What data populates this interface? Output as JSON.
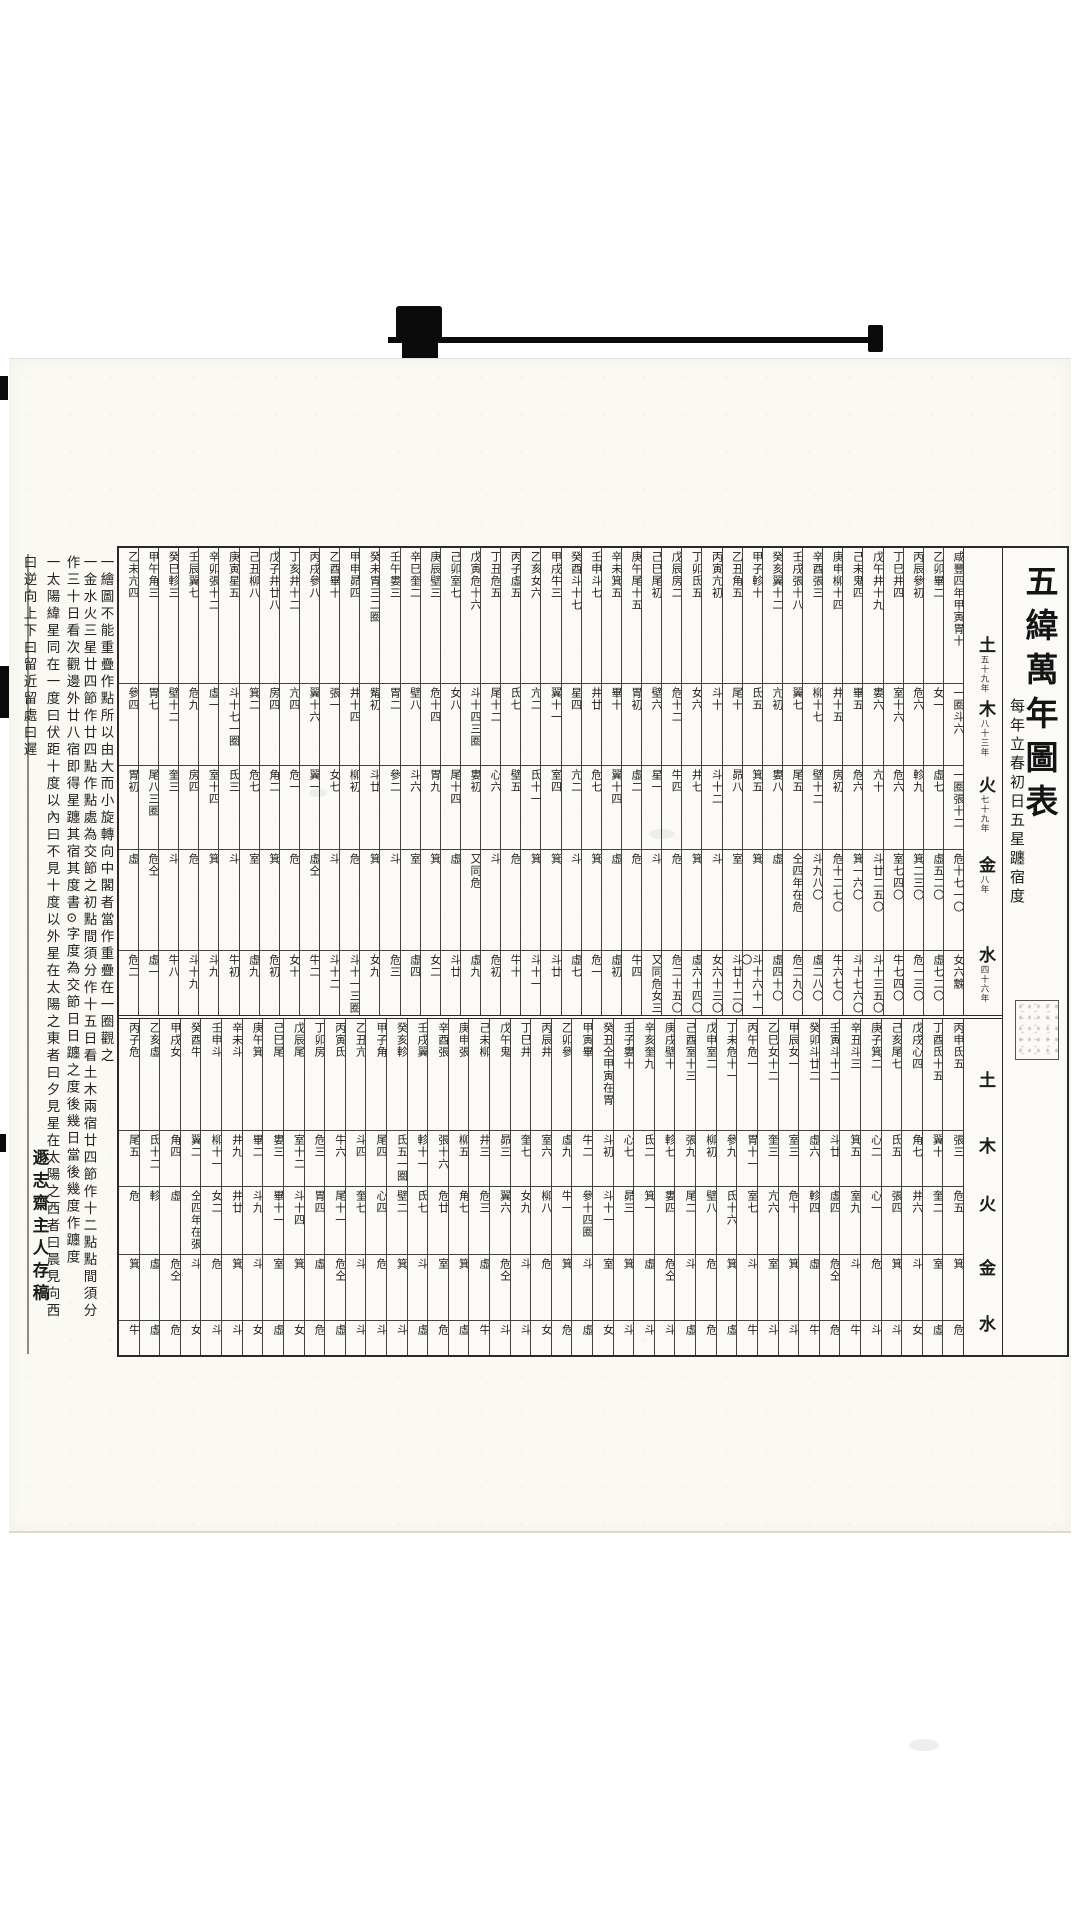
{
  "title": {
    "main": "五緯萬年圖表",
    "subtitle": "每年立春初日五星躔宿度"
  },
  "planet_labels": {
    "upper": [
      {
        "name": "土",
        "period": "五十九年"
      },
      {
        "name": "木",
        "period": "八十三年"
      },
      {
        "name": "火",
        "period": "七十九年"
      },
      {
        "name": "金",
        "period": "八年"
      },
      {
        "name": "水",
        "period": "四十六年"
      }
    ],
    "lower": [
      {
        "name": "土"
      },
      {
        "name": "木"
      },
      {
        "name": "火"
      },
      {
        "name": "金"
      },
      {
        "name": "水"
      }
    ]
  },
  "bands": {
    "upper": {
      "columns": [
        {
          "year": "咸豐四年甲寅",
          "saturn": "胃十",
          "wood": "一圈斗六",
          "fire": "一圈張十二",
          "venus": "危十七一〇",
          "mercury": "女六䨲"
        },
        {
          "year": "乙卯",
          "saturn": "畢二",
          "wood": "女一",
          "fire": "虛七",
          "venus": "虛五二〇",
          "mercury": "虛七二〇"
        },
        {
          "year": "丙辰",
          "saturn": "參初",
          "wood": "危六",
          "fire": "軫九",
          "venus": "箕二三〇",
          "mercury": "危一三〇"
        },
        {
          "year": "丁巳",
          "saturn": "井四",
          "wood": "室十六",
          "fire": "危六",
          "venus": "室七四〇",
          "mercury": "牛七四〇"
        },
        {
          "year": "戊午",
          "saturn": "井十九",
          "wood": "婁六",
          "fire": "亢十",
          "venus": "斗廿二五〇",
          "mercury": "斗十三五〇"
        },
        {
          "year": "己未",
          "saturn": "鬼四",
          "wood": "畢五",
          "fire": "危六",
          "venus": "箕一六〇",
          "mercury": "斗十七六〇"
        },
        {
          "year": "庚申",
          "saturn": "柳十四",
          "wood": "井十五",
          "fire": "房初",
          "venus": "危十二七〇",
          "mercury": "牛六七〇"
        },
        {
          "year": "辛酉",
          "saturn": "張三",
          "wood": "柳十七",
          "fire": "壁十二",
          "venus": "斗九八〇",
          "mercury": "虛二八〇"
        },
        {
          "year": "壬戌",
          "saturn": "張十八",
          "wood": "翼七",
          "fire": "尾五",
          "venus": "仝四年在危",
          "mercury": "危二九〇"
        },
        {
          "year": "癸亥",
          "saturn": "翼十二",
          "wood": "亢初",
          "fire": "婁八",
          "venus": "虛",
          "mercury": "虛四十〇"
        },
        {
          "year": "甲子",
          "saturn": "軫十",
          "wood": "氐五",
          "fire": "箕五",
          "venus": "箕",
          "mercury": "斗十六十一〇"
        },
        {
          "year": "乙丑",
          "saturn": "角五",
          "wood": "尾十",
          "fire": "昴八",
          "venus": "室",
          "mercury": "斗廿十二〇"
        },
        {
          "year": "丙寅",
          "saturn": "亢初",
          "wood": "斗十",
          "fire": "斗十二",
          "venus": "斗",
          "mercury": "女六十三〇"
        },
        {
          "year": "丁卯",
          "saturn": "氐五",
          "wood": "女六",
          "fire": "井七",
          "venus": "箕",
          "mercury": "虛六十四〇"
        },
        {
          "year": "戊辰",
          "saturn": "房二",
          "wood": "危十二",
          "fire": "牛四",
          "venus": "危",
          "mercury": "危二十五〇"
        },
        {
          "year": "己巳",
          "saturn": "尾初",
          "wood": "壁六",
          "fire": "星一",
          "venus": "斗",
          "mercury": "又同危女三"
        },
        {
          "year": "庚午",
          "saturn": "尾十五",
          "wood": "胃初",
          "fire": "虛二",
          "venus": "危",
          "mercury": "牛四"
        },
        {
          "year": "辛未",
          "saturn": "箕五",
          "wood": "畢十",
          "fire": "翼十四",
          "venus": "虛",
          "mercury": "虛初"
        },
        {
          "year": "壬申",
          "saturn": "斗七",
          "wood": "井廿",
          "fire": "危七",
          "venus": "箕",
          "mercury": "危一"
        },
        {
          "year": "癸酉",
          "saturn": "斗十七",
          "wood": "星四",
          "fire": "亢二",
          "venus": "斗",
          "mercury": "虛七"
        },
        {
          "year": "甲戌",
          "saturn": "牛三",
          "wood": "翼十一",
          "fire": "室四",
          "venus": "箕",
          "mercury": "斗廿"
        },
        {
          "year": "乙亥",
          "saturn": "女六",
          "wood": "亢二",
          "fire": "氐十一",
          "venus": "箕",
          "mercury": "斗十一"
        },
        {
          "year": "丙子",
          "saturn": "虛五",
          "wood": "氐七",
          "fire": "壁五",
          "venus": "危",
          "mercury": "牛十"
        },
        {
          "year": "丁丑",
          "saturn": "危五",
          "wood": "尾十二",
          "fire": "心六",
          "venus": "斗",
          "mercury": "危初"
        },
        {
          "year": "戊寅",
          "saturn": "危十六",
          "wood": "斗十四三圈",
          "fire": "婁初",
          "venus": "又同危",
          "mercury": "虛九"
        },
        {
          "year": "己卯",
          "saturn": "室七",
          "wood": "女八",
          "fire": "尾十四",
          "venus": "虛",
          "mercury": "斗廿"
        },
        {
          "year": "庚辰",
          "saturn": "壁三",
          "wood": "危十四",
          "fire": "胃九",
          "venus": "箕",
          "mercury": "女二"
        },
        {
          "year": "辛巳",
          "saturn": "奎二",
          "wood": "壁八",
          "fire": "斗六",
          "venus": "室",
          "mercury": "虛四"
        },
        {
          "year": "壬午",
          "saturn": "婁三",
          "wood": "胃二",
          "fire": "參二",
          "venus": "斗",
          "mercury": "危三"
        },
        {
          "year": "癸未",
          "saturn": "胃三二圈",
          "wood": "觜初",
          "fire": "斗廿",
          "venus": "箕",
          "mercury": "女九"
        },
        {
          "year": "甲申",
          "saturn": "昴四",
          "wood": "井十四",
          "fire": "柳初",
          "venus": "危",
          "mercury": "斗十一三圈"
        },
        {
          "year": "乙酉",
          "saturn": "畢十",
          "wood": "張一",
          "fire": "女七",
          "venus": "斗",
          "mercury": "斗十二"
        },
        {
          "year": "丙戌",
          "saturn": "參八",
          "wood": "翼十六",
          "fire": "翼一",
          "venus": "虛仝",
          "mercury": "牛二"
        },
        {
          "year": "丁亥",
          "saturn": "井十二",
          "wood": "亢四",
          "fire": "危一",
          "venus": "危",
          "mercury": "女十"
        },
        {
          "year": "戊子",
          "saturn": "井廿八",
          "wood": "房四",
          "fire": "角二",
          "venus": "箕",
          "mercury": "危初"
        },
        {
          "year": "己丑",
          "saturn": "柳八",
          "wood": "箕二",
          "fire": "危七",
          "venus": "室",
          "mercury": "虛九"
        },
        {
          "year": "庚寅",
          "saturn": "星五",
          "wood": "斗十七一圈",
          "fire": "氐三",
          "venus": "斗",
          "mercury": "牛初"
        },
        {
          "year": "辛卯",
          "saturn": "張十二",
          "wood": "虛一",
          "fire": "室十四",
          "venus": "箕",
          "mercury": "斗九"
        },
        {
          "year": "壬辰",
          "saturn": "翼七",
          "wood": "危九",
          "fire": "房四",
          "venus": "危",
          "mercury": "斗十九"
        },
        {
          "year": "癸巳",
          "saturn": "軫三",
          "wood": "壁十二",
          "fire": "奎三",
          "venus": "斗",
          "mercury": "牛八"
        },
        {
          "year": "甲午",
          "saturn": "角三",
          "wood": "胃七",
          "fire": "尾八三圈",
          "venus": "危仝",
          "mercury": "虛一"
        },
        {
          "year": "乙未",
          "saturn": "亢四",
          "wood": "參四",
          "fire": "胃初",
          "venus": "虛",
          "mercury": "危二"
        }
      ]
    },
    "lower": {
      "columns": [
        {
          "year": "丙申",
          "saturn": "氐五",
          "wood": "張三",
          "fire": "危五",
          "venus": "箕",
          "mercury": "危"
        },
        {
          "year": "丁酉",
          "saturn": "氐十五",
          "wood": "翼十",
          "fire": "奎二",
          "venus": "室",
          "mercury": "虛"
        },
        {
          "year": "戊戌",
          "saturn": "心四",
          "wood": "角七",
          "fire": "井六",
          "venus": "斗",
          "mercury": "女"
        },
        {
          "year": "己亥",
          "saturn": "尾七",
          "wood": "氐五",
          "fire": "張四",
          "venus": "箕",
          "mercury": "斗"
        },
        {
          "year": "庚子",
          "saturn": "箕二",
          "wood": "心二",
          "fire": "心一",
          "venus": "危",
          "mercury": "斗"
        },
        {
          "year": "辛丑",
          "saturn": "斗三",
          "wood": "箕五",
          "fire": "室九",
          "venus": "斗",
          "mercury": "牛"
        },
        {
          "year": "壬寅",
          "saturn": "斗十二",
          "wood": "斗廿",
          "fire": "虛四",
          "venus": "危仝",
          "mercury": "危"
        },
        {
          "year": "癸卯",
          "saturn": "斗廿二",
          "wood": "虛六",
          "fire": "軫四",
          "venus": "虛",
          "mercury": "牛"
        },
        {
          "year": "甲辰",
          "saturn": "女一",
          "wood": "室三",
          "fire": "危十",
          "venus": "箕",
          "mercury": "斗"
        },
        {
          "year": "乙巳",
          "saturn": "女十二",
          "wood": "奎三",
          "fire": "亢六",
          "venus": "室",
          "mercury": "斗"
        },
        {
          "year": "丙午",
          "saturn": "危一",
          "wood": "胃十一",
          "fire": "室七",
          "venus": "斗",
          "mercury": "牛"
        },
        {
          "year": "丁未",
          "saturn": "危十一",
          "wood": "參九",
          "fire": "氐十六",
          "venus": "箕",
          "mercury": "虛"
        },
        {
          "year": "戊申",
          "saturn": "室二",
          "wood": "柳初",
          "fire": "壁八",
          "venus": "危",
          "mercury": "危"
        },
        {
          "year": "己酉",
          "saturn": "室十三",
          "wood": "張九",
          "fire": "尾二",
          "venus": "斗",
          "mercury": "虛"
        },
        {
          "year": "庚戌",
          "saturn": "壁十",
          "wood": "軫七",
          "fire": "婁四",
          "venus": "危仝",
          "mercury": "斗"
        },
        {
          "year": "辛亥",
          "saturn": "奎九",
          "wood": "氐二",
          "fire": "箕一",
          "venus": "虛",
          "mercury": "斗"
        },
        {
          "year": "壬子",
          "saturn": "婁十",
          "wood": "心七",
          "fire": "昴三",
          "venus": "箕",
          "mercury": "斗"
        },
        {
          "year": "癸丑",
          "saturn": "仝甲寅在胃",
          "wood": "斗初",
          "fire": "斗十一",
          "venus": "室",
          "mercury": "女"
        },
        {
          "year": "甲寅",
          "saturn": "畢",
          "wood": "牛二",
          "fire": "參十四圈",
          "venus": "斗",
          "mercury": "虛"
        },
        {
          "year": "乙卯",
          "saturn": "參",
          "wood": "虛九",
          "fire": "牛一",
          "venus": "箕",
          "mercury": "危"
        },
        {
          "year": "丙辰",
          "saturn": "井",
          "wood": "室六",
          "fire": "柳八",
          "venus": "危",
          "mercury": "女"
        },
        {
          "year": "丁巳",
          "saturn": "井",
          "wood": "奎七",
          "fire": "女九",
          "venus": "斗",
          "mercury": "斗"
        },
        {
          "year": "戊午",
          "saturn": "鬼",
          "wood": "昴三",
          "fire": "翼六",
          "venus": "危仝",
          "mercury": "斗"
        },
        {
          "year": "己未",
          "saturn": "柳",
          "wood": "井三",
          "fire": "危三",
          "venus": "虛",
          "mercury": "牛"
        },
        {
          "year": "庚申",
          "saturn": "張",
          "wood": "柳五",
          "fire": "角七",
          "venus": "箕",
          "mercury": "虛"
        },
        {
          "year": "辛酉",
          "saturn": "張",
          "wood": "張十六",
          "fire": "危廿",
          "venus": "室",
          "mercury": "危"
        },
        {
          "year": "壬戌",
          "saturn": "翼",
          "wood": "軫十一",
          "fire": "氐七",
          "venus": "斗",
          "mercury": "虛"
        },
        {
          "year": "癸亥",
          "saturn": "軫",
          "wood": "氐五一圈",
          "fire": "壁二",
          "venus": "箕",
          "mercury": "斗"
        },
        {
          "year": "甲子",
          "saturn": "角",
          "wood": "尾四",
          "fire": "心四",
          "venus": "危",
          "mercury": "斗"
        },
        {
          "year": "乙丑",
          "saturn": "亢",
          "wood": "斗四",
          "fire": "奎七",
          "venus": "斗",
          "mercury": "斗"
        },
        {
          "year": "丙寅",
          "saturn": "氐",
          "wood": "牛六",
          "fire": "尾十一",
          "venus": "危仝",
          "mercury": "虛"
        },
        {
          "year": "丁卯",
          "saturn": "房",
          "wood": "危三",
          "fire": "胃四",
          "venus": "虛",
          "mercury": "危"
        },
        {
          "year": "戊辰",
          "saturn": "尾",
          "wood": "室十二",
          "fire": "斗十四",
          "venus": "箕",
          "mercury": "女"
        },
        {
          "year": "己巳",
          "saturn": "尾",
          "wood": "婁三",
          "fire": "畢十一",
          "venus": "室",
          "mercury": "虛"
        },
        {
          "year": "庚午",
          "saturn": "箕",
          "wood": "畢二",
          "fire": "斗九",
          "venus": "斗",
          "mercury": "女"
        },
        {
          "year": "辛未",
          "saturn": "斗",
          "wood": "井九",
          "fire": "井廿",
          "venus": "箕",
          "mercury": "斗"
        },
        {
          "year": "壬申",
          "saturn": "斗",
          "wood": "柳十一",
          "fire": "女二",
          "venus": "危",
          "mercury": "斗"
        },
        {
          "year": "癸酉",
          "saturn": "牛",
          "wood": "翼二",
          "fire": "仝四年在張",
          "venus": "斗",
          "mercury": "女"
        },
        {
          "year": "甲戌",
          "saturn": "女",
          "wood": "角四",
          "fire": "虛",
          "venus": "危仝",
          "mercury": "危"
        },
        {
          "year": "乙亥",
          "saturn": "虛",
          "wood": "氐十二",
          "fire": "軫",
          "venus": "虛",
          "mercury": "虛"
        },
        {
          "year": "丙子",
          "saturn": "危",
          "wood": "尾五",
          "fire": "危",
          "venus": "箕",
          "mercury": "牛"
        }
      ]
    }
  },
  "notes": {
    "columns": [
      "一繪圖不能重疊作點所以由大而小旋轉向中閣者當作重疊在一圈觀之",
      "一金水火三星廿四節作廿四點作點處為交節之初點間須分作十五日看土木兩宿廿四節作十二點點間須分",
      "作三十日看次觀邊外廿八宿即得星躔其宿其度書⊙字度為交節日日躔之度後幾日當後幾度作躔度",
      "一太陽緯星同在一度曰伏距十度以內曰不見十度以外星在太陽之東者曰夕見星在太陽之西者曰晨見向西",
      "曰逆向上下曰留近留處曰遲"
    ],
    "signature": "遯志齋主人存稿"
  }
}
